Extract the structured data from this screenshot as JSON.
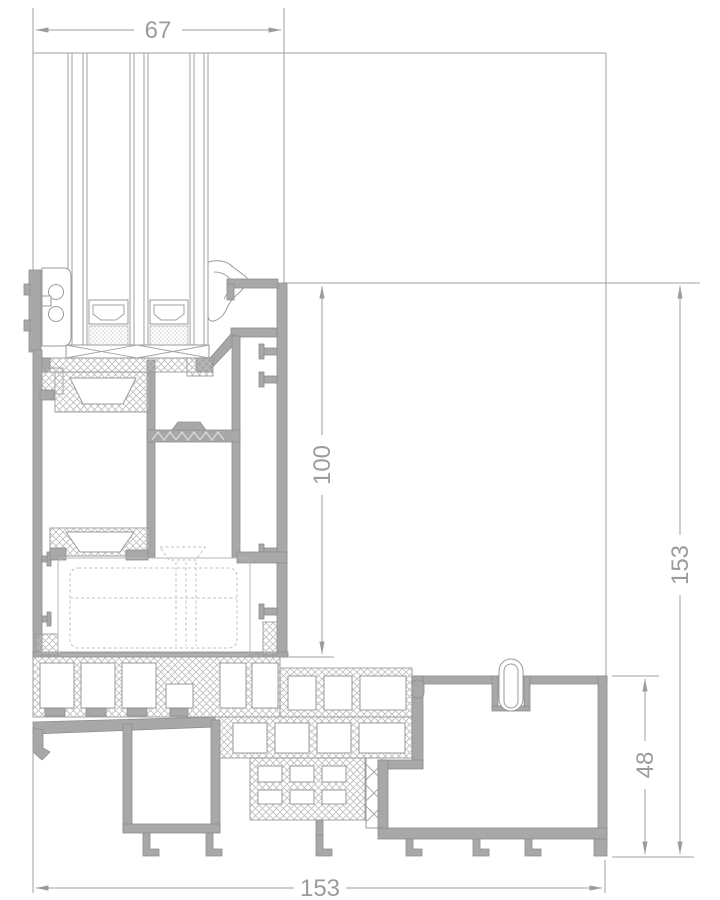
{
  "drawing": {
    "type": "technical-cross-section",
    "subject": "aluminium window sill profile section with triple glazing",
    "dimensions": {
      "glazing_width": {
        "value": "67",
        "orientation": "horizontal",
        "position": "top"
      },
      "frame_height": {
        "value": "100",
        "orientation": "vertical",
        "position": "inner-right"
      },
      "overall_height": {
        "value": "153",
        "orientation": "vertical",
        "position": "far-right"
      },
      "sill_height": {
        "value": "48",
        "orientation": "vertical",
        "position": "lower-right"
      },
      "overall_width": {
        "value": "153",
        "orientation": "horizontal",
        "position": "bottom"
      }
    },
    "colors": {
      "background": "#ffffff",
      "dimension_gray": "#9c9c9c",
      "profile_fill": "#a8a8a8",
      "profile_edge": "#8d8d8d",
      "hatch_gray": "#bcbcbc",
      "hidden_line_gray": "#c0c0c0"
    },
    "components": [
      "triple-glazing-unit",
      "glazing-spacers",
      "glazing-gasket-left",
      "glazing-wedge-gasket-right",
      "setting-block",
      "thermal-break-zone",
      "frame-profile",
      "hidden-sash-outline",
      "sill-base-profile",
      "end-cap-profile",
      "seal-clip-loop",
      "drip-edge"
    ]
  }
}
